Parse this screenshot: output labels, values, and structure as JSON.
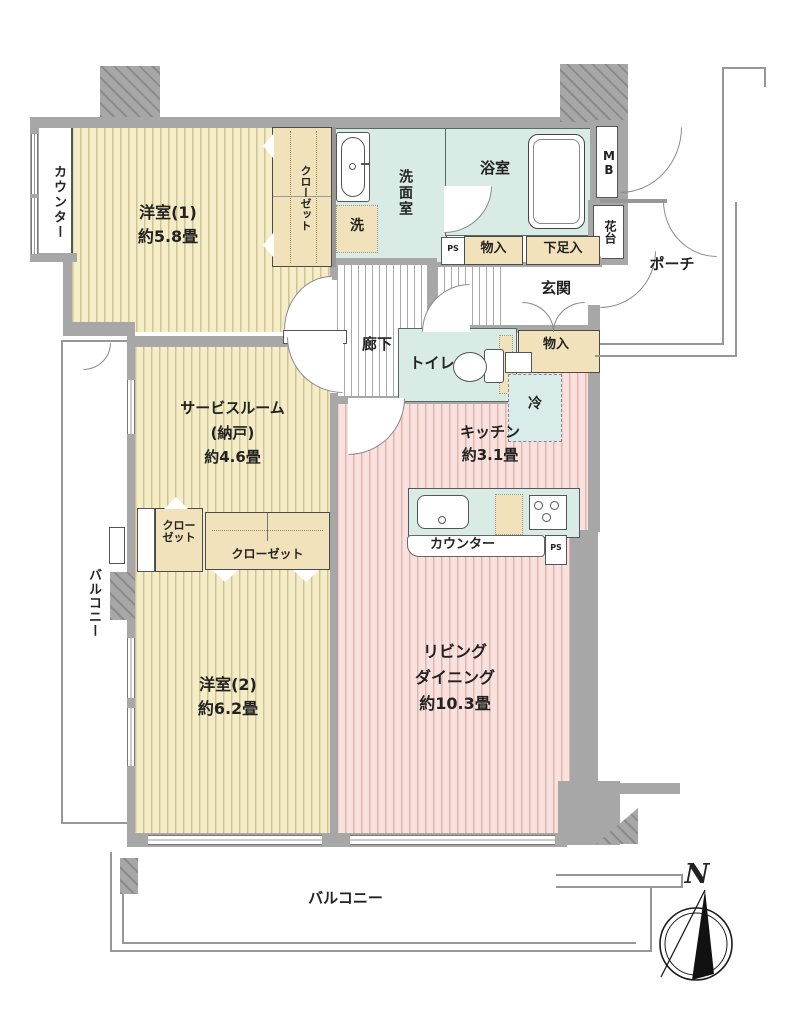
{
  "rooms": {
    "western1": {
      "name": "洋室(1)",
      "size": "約5.8畳"
    },
    "western2": {
      "name": "洋室(2)",
      "size": "約6.2畳"
    },
    "service_room": {
      "name": "サービスルーム",
      "sub": "(納戸)",
      "size": "約4.6畳"
    },
    "living_dining": {
      "line1": "リビング",
      "line2": "ダイニング",
      "size": "約10.3畳"
    },
    "kitchen": {
      "name": "キッチン",
      "size": "約3.1畳"
    },
    "washroom": "洗面室",
    "bathroom": "浴室",
    "toilet": "トイレ",
    "corridor": "廊下",
    "entrance": "玄関",
    "porch": "ポーチ"
  },
  "features": {
    "counter_bay": "カウンター",
    "closet_west1": "クローゼット",
    "closet_small": "クローゼット",
    "closet_wide": "クローゼット",
    "washing_machine": "洗",
    "meter_box": "MB",
    "flower_stand": "花台",
    "storage_upper": "物入",
    "shoe_cabinet": "下足入",
    "storage_entrance": "物入",
    "refrigerator": "冷",
    "pipe_space_upper": "PS",
    "pipe_space_kitchen": "PS",
    "kitchen_counter": "カウンター"
  },
  "balconies": {
    "left": "バルコニー",
    "bottom": "バルコニー"
  },
  "compass": {
    "north": "N"
  },
  "colors": {
    "tatami_room": "#f5ecc8",
    "living_pink": "#f9e2dd",
    "wet_area": "#d8ebe4",
    "storage_cream": "#f2e2bb",
    "wall_gray": "#a7a7a7"
  }
}
